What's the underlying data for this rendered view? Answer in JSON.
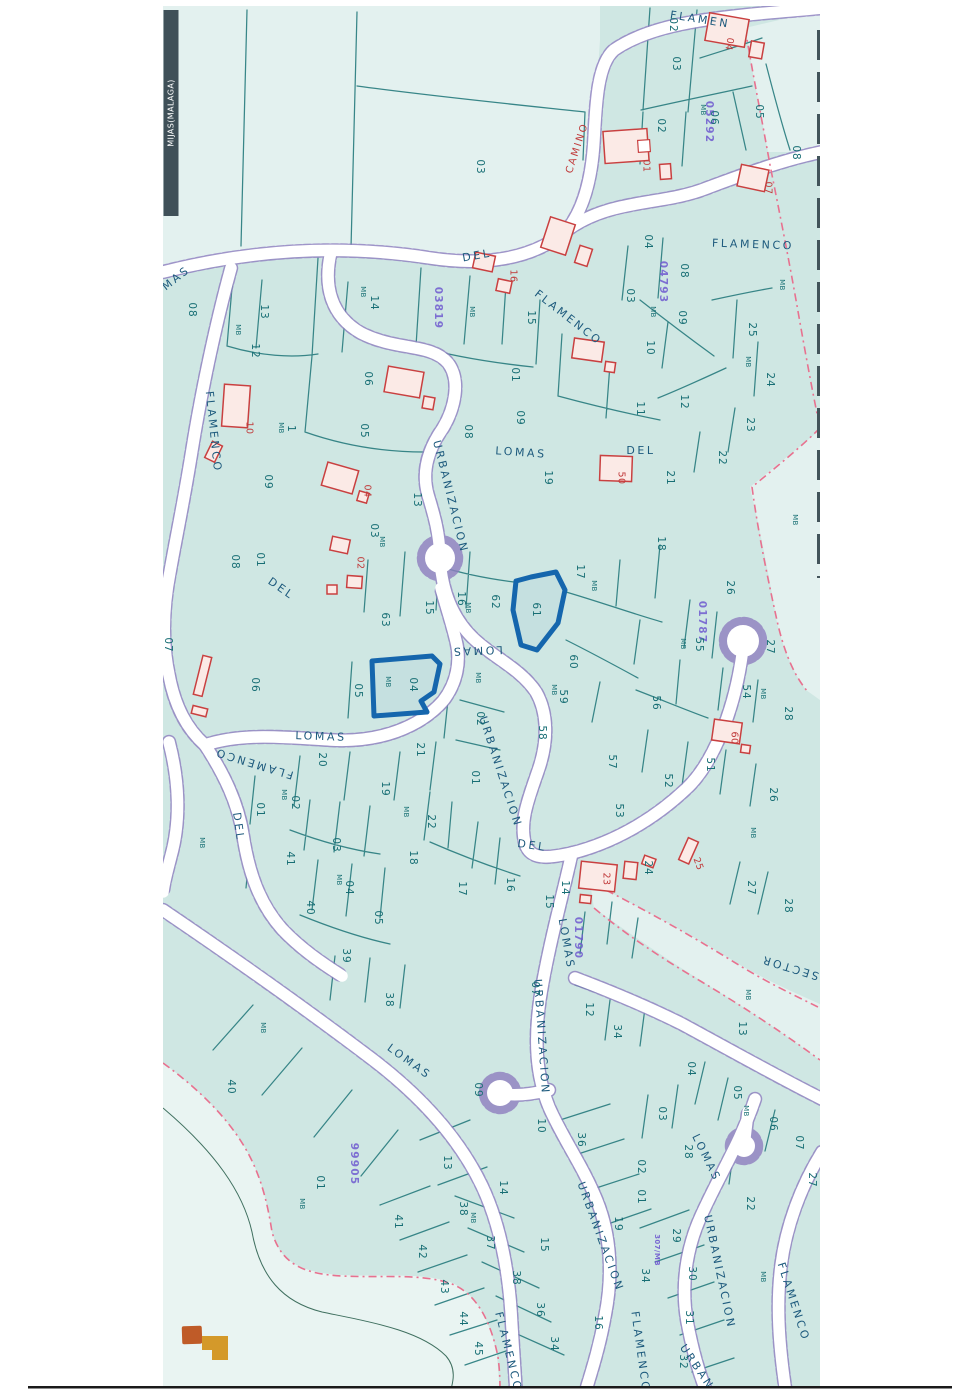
{
  "map": {
    "municipality_label": "MIJAS(MALAGA)",
    "highlighted_parcels": [
      "04",
      "61"
    ],
    "colors": {
      "background": "#cfe7e3",
      "road": "#ffffff",
      "road_casing": "#8f7fc0",
      "parcel_line": "#2e8082",
      "parcel_text": "#176e74",
      "street_text": "#1d5a7d",
      "sector_code_text": "#6f5bd0",
      "house_outline": "#c94040",
      "highlight_blue": "#1566ad",
      "sector_boundary_pink": "#e8718f",
      "legend_orange": "#bf5b28",
      "legend_gold": "#d4992a",
      "title_bar": "#3f5058"
    },
    "labels": [
      [
        "OMAS",
        172,
        282,
        -38,
        "s"
      ],
      [
        "FLAMEN",
        700,
        20,
        9,
        "s"
      ],
      [
        "DEL",
        477,
        256,
        -10,
        "s"
      ],
      [
        "FLAMENCO",
        568,
        318,
        38,
        "s"
      ],
      [
        "FLAMENCO",
        753,
        245,
        2,
        "s"
      ],
      [
        "FLAMENCO",
        213,
        432,
        84,
        "s"
      ],
      [
        "LOMAS",
        521,
        453,
        4,
        "s"
      ],
      [
        "DEL",
        641,
        451,
        0,
        "s"
      ],
      [
        "URBANIZACION",
        450,
        497,
        76,
        "s"
      ],
      [
        "LOMAS",
        477,
        650,
        178,
        "s"
      ],
      [
        "LOMAS",
        321,
        737,
        2,
        "s"
      ],
      [
        "FLAMENCO",
        254,
        763,
        197,
        "s"
      ],
      [
        "DEL",
        238,
        827,
        82,
        "s"
      ],
      [
        "DEL",
        281,
        589,
        35,
        "s"
      ],
      [
        "URBANIZACION",
        500,
        772,
        72,
        "s"
      ],
      [
        "DEL",
        532,
        846,
        8,
        "s"
      ],
      [
        "LOMAS",
        566,
        944,
        80,
        "s"
      ],
      [
        "SECTOR",
        790,
        967,
        197,
        "s"
      ],
      [
        "LOMAS",
        409,
        1062,
        36,
        "s"
      ],
      [
        "URBANIZACION",
        541,
        1037,
        86,
        "s"
      ],
      [
        "LOMAS",
        706,
        1158,
        64,
        "s"
      ],
      [
        "URBANIZACION",
        600,
        1237,
        70,
        "s"
      ],
      [
        "URBANIZACION",
        719,
        1272,
        78,
        "s"
      ],
      [
        "FLAMENCO",
        508,
        1352,
        76,
        "s"
      ],
      [
        "FLAMENCO",
        640,
        1352,
        82,
        "s"
      ],
      [
        "FLAMENCO",
        793,
        1302,
        72,
        "s"
      ],
      [
        "URBANIZ",
        701,
        1374,
        56,
        "s"
      ],
      [
        "CAMINO",
        577,
        148,
        -72,
        "c"
      ],
      [
        "03819",
        438,
        308,
        90,
        "k"
      ],
      [
        "05292",
        709,
        122,
        90,
        "k"
      ],
      [
        "04793",
        663,
        282,
        90,
        "k"
      ],
      [
        "01787",
        702,
        622,
        90,
        "k"
      ],
      [
        "01790",
        578,
        938,
        90,
        "k"
      ],
      [
        "99905",
        354,
        1164,
        90,
        "k"
      ],
      [
        "307/MB",
        657,
        1250,
        90,
        "k2"
      ],
      [
        "04",
        729,
        44,
        100,
        "h"
      ],
      [
        "01",
        646,
        166,
        90,
        "h"
      ],
      [
        "07",
        768,
        188,
        90,
        "h"
      ],
      [
        "16",
        513,
        276,
        90,
        "h"
      ],
      [
        "10",
        249,
        428,
        90,
        "h"
      ],
      [
        "04",
        367,
        491,
        90,
        "h"
      ],
      [
        "02",
        360,
        563,
        90,
        "h"
      ],
      [
        "50",
        621,
        478,
        90,
        "h"
      ],
      [
        "60",
        734,
        738,
        90,
        "h"
      ],
      [
        "23",
        606,
        879,
        90,
        "h"
      ],
      [
        "25",
        698,
        864,
        70,
        "h"
      ],
      [
        "03",
        480,
        167,
        90,
        "p"
      ],
      [
        "02",
        673,
        25,
        90,
        "p"
      ],
      [
        "03",
        676,
        64,
        90,
        "p"
      ],
      [
        "05",
        759,
        112,
        90,
        "p"
      ],
      [
        "06",
        714,
        118,
        90,
        "p"
      ],
      [
        "MB",
        703,
        110,
        90,
        "m"
      ],
      [
        "02",
        661,
        126,
        90,
        "p"
      ],
      [
        "08",
        796,
        153,
        90,
        "p"
      ],
      [
        "08",
        192,
        310,
        90,
        "p"
      ],
      [
        "13",
        264,
        312,
        90,
        "p"
      ],
      [
        "MB",
        238,
        330,
        90,
        "m"
      ],
      [
        "12",
        255,
        351,
        90,
        "p"
      ],
      [
        "MB",
        363,
        292,
        90,
        "m"
      ],
      [
        "14",
        374,
        303,
        90,
        "p"
      ],
      [
        "MB",
        472,
        312,
        90,
        "m"
      ],
      [
        "15",
        531,
        318,
        90,
        "p"
      ],
      [
        "03",
        630,
        296,
        90,
        "p"
      ],
      [
        "08",
        684,
        271,
        90,
        "p"
      ],
      [
        "04",
        648,
        242,
        90,
        "p"
      ],
      [
        "MB",
        653,
        312,
        90,
        "m"
      ],
      [
        "09",
        682,
        318,
        90,
        "p"
      ],
      [
        "10",
        650,
        348,
        90,
        "p"
      ],
      [
        "MB",
        782,
        285,
        90,
        "m"
      ],
      [
        "25",
        752,
        330,
        90,
        "p"
      ],
      [
        "MB",
        748,
        362,
        90,
        "m"
      ],
      [
        "24",
        770,
        380,
        90,
        "p"
      ],
      [
        "12",
        684,
        402,
        90,
        "p"
      ],
      [
        "23",
        750,
        425,
        90,
        "p"
      ],
      [
        "22",
        722,
        458,
        90,
        "p"
      ],
      [
        "21",
        670,
        478,
        90,
        "p"
      ],
      [
        "01",
        515,
        375,
        90,
        "p"
      ],
      [
        "09",
        520,
        418,
        90,
        "p"
      ],
      [
        "08",
        468,
        432,
        90,
        "p"
      ],
      [
        "05",
        364,
        431,
        90,
        "p"
      ],
      [
        "06",
        368,
        379,
        90,
        "p"
      ],
      [
        "11",
        640,
        409,
        90,
        "p"
      ],
      [
        "MB",
        281,
        428,
        90,
        "m"
      ],
      [
        "1",
        291,
        429,
        90,
        "p"
      ],
      [
        "19",
        548,
        478,
        90,
        "p"
      ],
      [
        "18",
        661,
        544,
        90,
        "p"
      ],
      [
        "17",
        580,
        572,
        90,
        "p"
      ],
      [
        "MB",
        594,
        586,
        90,
        "m"
      ],
      [
        "26",
        730,
        588,
        90,
        "p"
      ],
      [
        "13",
        417,
        500,
        90,
        "p"
      ],
      [
        "03",
        374,
        531,
        90,
        "p"
      ],
      [
        "MB",
        382,
        542,
        90,
        "m"
      ],
      [
        "01",
        260,
        560,
        90,
        "p"
      ],
      [
        "09",
        268,
        482,
        90,
        "p"
      ],
      [
        "08",
        235,
        562,
        90,
        "p"
      ],
      [
        "07",
        168,
        645,
        90,
        "p"
      ],
      [
        "06",
        255,
        685,
        90,
        "p"
      ],
      [
        "63",
        385,
        620,
        90,
        "p"
      ],
      [
        "15",
        429,
        608,
        90,
        "p"
      ],
      [
        "16",
        461,
        599,
        90,
        "p"
      ],
      [
        "MB",
        468,
        608,
        90,
        "m"
      ],
      [
        "62",
        495,
        602,
        90,
        "p"
      ],
      [
        "61",
        536,
        610,
        90,
        "p"
      ],
      [
        "60",
        573,
        662,
        90,
        "p"
      ],
      [
        "MB",
        554,
        690,
        90,
        "m"
      ],
      [
        "59",
        563,
        697,
        90,
        "p"
      ],
      [
        "58",
        542,
        733,
        90,
        "p"
      ],
      [
        "57",
        612,
        762,
        90,
        "p"
      ],
      [
        "MB",
        683,
        644,
        90,
        "m"
      ],
      [
        "55",
        699,
        645,
        90,
        "p"
      ],
      [
        "56",
        656,
        703,
        90,
        "p"
      ],
      [
        "27",
        770,
        647,
        90,
        "p"
      ],
      [
        "54",
        746,
        692,
        90,
        "p"
      ],
      [
        "MB",
        763,
        694,
        90,
        "m"
      ],
      [
        "28",
        788,
        714,
        90,
        "p"
      ],
      [
        "05",
        358,
        691,
        90,
        "p"
      ],
      [
        "MB",
        388,
        682,
        90,
        "m"
      ],
      [
        "04",
        413,
        685,
        90,
        "p"
      ],
      [
        "MB",
        478,
        678,
        90,
        "m"
      ],
      [
        "02",
        480,
        719,
        90,
        "p"
      ],
      [
        "21",
        420,
        750,
        90,
        "p"
      ],
      [
        "01",
        475,
        778,
        90,
        "p"
      ],
      [
        "19",
        385,
        789,
        90,
        "p"
      ],
      [
        "20",
        322,
        760,
        90,
        "p"
      ],
      [
        "MB",
        202,
        843,
        90,
        "m"
      ],
      [
        "01",
        260,
        810,
        90,
        "p"
      ],
      [
        "MB",
        284,
        795,
        90,
        "m"
      ],
      [
        "02",
        295,
        803,
        90,
        "p"
      ],
      [
        "41",
        290,
        859,
        90,
        "p"
      ],
      [
        "03",
        336,
        845,
        90,
        "p"
      ],
      [
        "MB",
        339,
        880,
        90,
        "m"
      ],
      [
        "04",
        349,
        888,
        90,
        "p"
      ],
      [
        "40",
        310,
        908,
        90,
        "p"
      ],
      [
        "05",
        378,
        918,
        90,
        "p"
      ],
      [
        "39",
        346,
        956,
        90,
        "p"
      ],
      [
        "38",
        389,
        1000,
        90,
        "p"
      ],
      [
        "22",
        431,
        822,
        90,
        "p"
      ],
      [
        "MB",
        406,
        812,
        90,
        "m"
      ],
      [
        "18",
        413,
        858,
        90,
        "p"
      ],
      [
        "17",
        462,
        889,
        90,
        "p"
      ],
      [
        "16",
        510,
        885,
        90,
        "p"
      ],
      [
        "14",
        565,
        888,
        90,
        "p"
      ],
      [
        "15",
        549,
        902,
        90,
        "p"
      ],
      [
        "53",
        619,
        811,
        90,
        "p"
      ],
      [
        "52",
        668,
        781,
        90,
        "p"
      ],
      [
        "51",
        710,
        765,
        90,
        "p"
      ],
      [
        "26",
        773,
        795,
        90,
        "p"
      ],
      [
        "MB",
        753,
        833,
        90,
        "m"
      ],
      [
        "24",
        648,
        868,
        90,
        "p"
      ],
      [
        "27",
        751,
        888,
        90,
        "p"
      ],
      [
        "28",
        788,
        906,
        90,
        "p"
      ],
      [
        "MB",
        795,
        520,
        90,
        "m"
      ],
      [
        "MB",
        748,
        995,
        90,
        "m"
      ],
      [
        "13",
        742,
        1029,
        90,
        "p"
      ],
      [
        "12",
        589,
        1010,
        90,
        "p"
      ],
      [
        "34",
        617,
        1032,
        90,
        "p"
      ],
      [
        "07",
        535,
        989,
        90,
        "p"
      ],
      [
        "04",
        691,
        1069,
        90,
        "p"
      ],
      [
        "05",
        737,
        1093,
        90,
        "p"
      ],
      [
        "MB",
        746,
        1111,
        90,
        "m"
      ],
      [
        "06",
        773,
        1124,
        90,
        "p"
      ],
      [
        "07",
        799,
        1143,
        90,
        "p"
      ],
      [
        "10",
        541,
        1126,
        90,
        "p"
      ],
      [
        "36",
        581,
        1140,
        90,
        "p"
      ],
      [
        "03",
        662,
        1114,
        90,
        "p"
      ],
      [
        "02",
        641,
        1167,
        90,
        "p"
      ],
      [
        "01",
        641,
        1197,
        90,
        "p"
      ],
      [
        "28",
        688,
        1152,
        90,
        "p"
      ],
      [
        "19",
        618,
        1224,
        90,
        "p"
      ],
      [
        "29",
        676,
        1236,
        90,
        "p"
      ],
      [
        "34",
        645,
        1276,
        90,
        "p"
      ],
      [
        "30",
        692,
        1274,
        90,
        "p"
      ],
      [
        "31",
        689,
        1318,
        90,
        "p"
      ],
      [
        "32",
        683,
        1362,
        90,
        "p"
      ],
      [
        "27",
        812,
        1180,
        90,
        "p"
      ],
      [
        "22",
        750,
        1204,
        90,
        "p"
      ],
      [
        "MB",
        763,
        1277,
        90,
        "m"
      ],
      [
        "40",
        231,
        1087,
        90,
        "p"
      ],
      [
        "01",
        320,
        1183,
        90,
        "p"
      ],
      [
        "MB",
        302,
        1204,
        90,
        "m"
      ],
      [
        "MB",
        263,
        1028,
        90,
        "m"
      ],
      [
        "13",
        447,
        1163,
        90,
        "p"
      ],
      [
        "41",
        398,
        1222,
        90,
        "p"
      ],
      [
        "42",
        422,
        1252,
        90,
        "p"
      ],
      [
        "43",
        444,
        1287,
        90,
        "p"
      ],
      [
        "44",
        463,
        1319,
        90,
        "p"
      ],
      [
        "45",
        478,
        1349,
        90,
        "p"
      ],
      [
        "38",
        463,
        1209,
        90,
        "p"
      ],
      [
        "MB",
        473,
        1218,
        90,
        "m"
      ],
      [
        "14",
        503,
        1188,
        90,
        "p"
      ],
      [
        "15",
        544,
        1245,
        90,
        "p"
      ],
      [
        "37",
        490,
        1243,
        90,
        "p"
      ],
      [
        "38",
        516,
        1278,
        90,
        "p"
      ],
      [
        "36",
        540,
        1310,
        90,
        "p"
      ],
      [
        "34",
        554,
        1344,
        90,
        "p"
      ],
      [
        "16",
        598,
        1323,
        90,
        "p"
      ],
      [
        "09",
        478,
        1090,
        90,
        "p"
      ]
    ]
  }
}
